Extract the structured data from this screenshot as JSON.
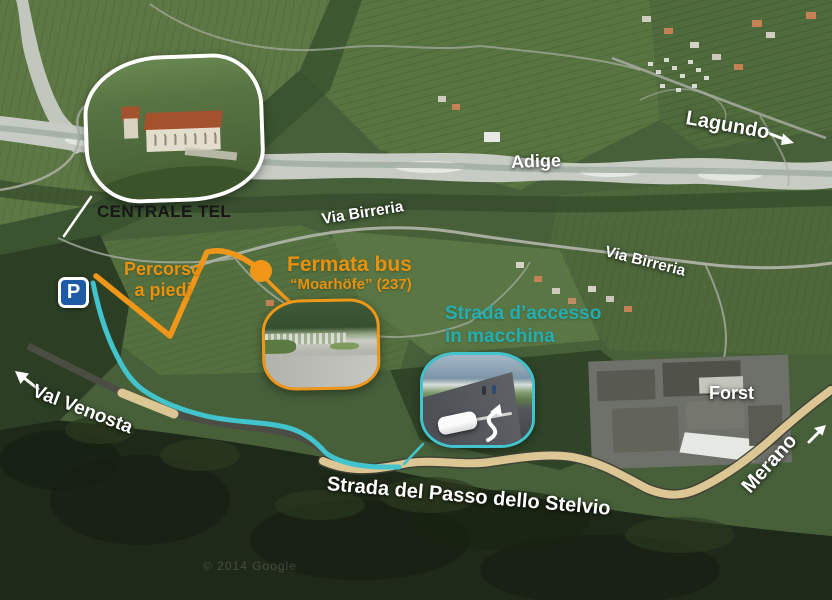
{
  "map": {
    "watermark": "© 2014 Google",
    "labels": {
      "centrale": "CENTRALE TEL",
      "lagundo": "Lagundo",
      "adige": "Adige",
      "via_birreria_1": "Via Birreria",
      "via_birreria_2": "Via Birreria",
      "percorso_line1": "Percorso",
      "percorso_line2": "a piedi",
      "fermata_title": "Fermata bus",
      "fermata_sub": "“Moarhöfe” (237)",
      "strada_accesso_line1": "Strada d’accesso",
      "strada_accesso_line2": "in macchina",
      "val_venosta": "Val Venosta",
      "stelvio": "Strada del Passo dello Stelvio",
      "forst": "Forst",
      "merano": "Merano"
    },
    "icons": {
      "parking_symbol": "P",
      "val_venosta_arrow": "arrow-up-left",
      "lagundo_arrow": "arrow-right",
      "merano_arrow": "arrow-up-right",
      "bus_stop": "orange-dot"
    },
    "colors": {
      "walk_orange": "#F0971A",
      "walk_orange_text": "#E8910E",
      "drive_teal": "#41C4CE",
      "drive_teal_text": "#23AEB2",
      "road_tan": "#DCC794",
      "parking_blue": "#1E5AA5",
      "label_white": "#FFFFFF",
      "label_black": "#161616"
    }
  }
}
